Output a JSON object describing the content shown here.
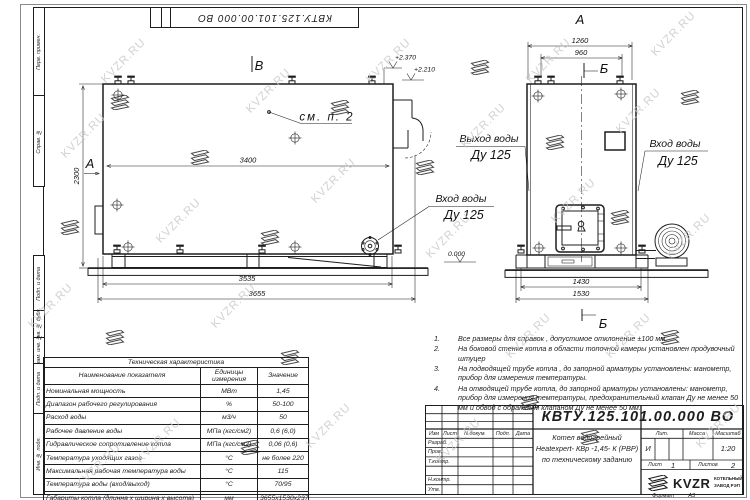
{
  "doc_number": "КВТУ.125.101.00.000  ВО",
  "watermark": "KVZR.RU",
  "frame": {
    "side_labels": [
      "Перв. примен.",
      "Справ. №",
      "Подп. и дата",
      "Инв. № дубл.",
      "Взам. инв. №",
      "Подп. и дата",
      "Инв. № подл."
    ]
  },
  "views": {
    "side": {
      "marker_top": "В",
      "marker_left": "А",
      "see_note": "см. п. 2",
      "dim_inner": "3400",
      "dim_height": "2300",
      "dim_base": "3535",
      "dim_total": "3655",
      "elev_top": "+2.370",
      "elev_mid": "+2.210",
      "inlet_line1": "Вход воды",
      "inlet_line2": "Ду 125"
    },
    "front": {
      "marker_top": "А",
      "marker_section_top": "Б",
      "marker_section_bottom": "Б",
      "dim_outer": "1260",
      "dim_inner": "960",
      "dim_base_inner": "1430",
      "dim_base_outer": "1530",
      "elev_zero": "0.000",
      "outlet_line1": "Выход воды",
      "outlet_line2": "Ду 125",
      "inlet_line1": "Вход воды",
      "inlet_line2": "Ду 125"
    }
  },
  "notes": [
    {
      "num": "1.",
      "text": "Все размеры для справок , допустимое отклонение  ±100 мм."
    },
    {
      "num": "2.",
      "text": "На боковой стенке котла в области топочной камеры установлен продувочный штуцер"
    },
    {
      "num": "3.",
      "text": "На  подводящей трубе котла , до запорной арматуры установлены:  манометр, прибор для измерения температуры."
    },
    {
      "num": "4.",
      "text": "На отводящей трубе котла, до запорной арматуры установлены:  манометр, прибор для измерения температуры, предохранительный клапан  Ду не менее  50 мм и обвод с обратным клапаном  Ду не менее  50 мм."
    }
  ],
  "tech_table": {
    "title": "Техническая характеристика",
    "headers": [
      "Наименование показателя",
      "Единицы измерения",
      "Значение"
    ],
    "rows": [
      [
        "Номинальная мощность",
        "МВт",
        "1,45"
      ],
      [
        "Диапазон рабочего регулирования",
        "%",
        "50-100"
      ],
      [
        "Расход воды",
        "м3/ч",
        "50"
      ],
      [
        "Рабочее давление воды",
        "МПа (кгс/см2)",
        "0,6 (6,0)"
      ],
      [
        "Гидравлическое сопротивление котла",
        "МПа (кгс/см2)",
        "0,06 (0,6)"
      ],
      [
        "Температура уходящих газов",
        "°С",
        "не более 220"
      ],
      [
        "Максимальная рабочая температура воды",
        "°С",
        "115"
      ],
      [
        "Температура воды (вход/выход)",
        "°С",
        "70/95"
      ],
      [
        "Габариты котла (длинна х ширина х высота)",
        "мм",
        "3655х1530х2370"
      ]
    ]
  },
  "title_block": {
    "header_cells": [
      "Изм",
      "Лист",
      "N докум.",
      "Подп.",
      "Дата"
    ],
    "row_labels": [
      "Разраб.",
      "Пров.",
      "Т.контр.",
      "Н.контр.",
      "Утв."
    ],
    "product": [
      "Котел водогрейный",
      "Heatexpert- КВр -1,45- К (РВР)",
      "по техническому заданию"
    ],
    "lit_label": "Лит.",
    "lit_value": "И",
    "mass_label": "Масса",
    "scale_label": "Масштаб",
    "scale_value": "1:20",
    "sheet_label": "Лист",
    "sheet_value": "1",
    "sheets_label": "Листов",
    "sheets_value": "2",
    "logo_text": "KVZR",
    "company_line1": "КОТЕЛЬНЫЙ",
    "company_line2": "ЗАВОД РЭП",
    "format_label": "Формат",
    "format_value": "А3"
  }
}
